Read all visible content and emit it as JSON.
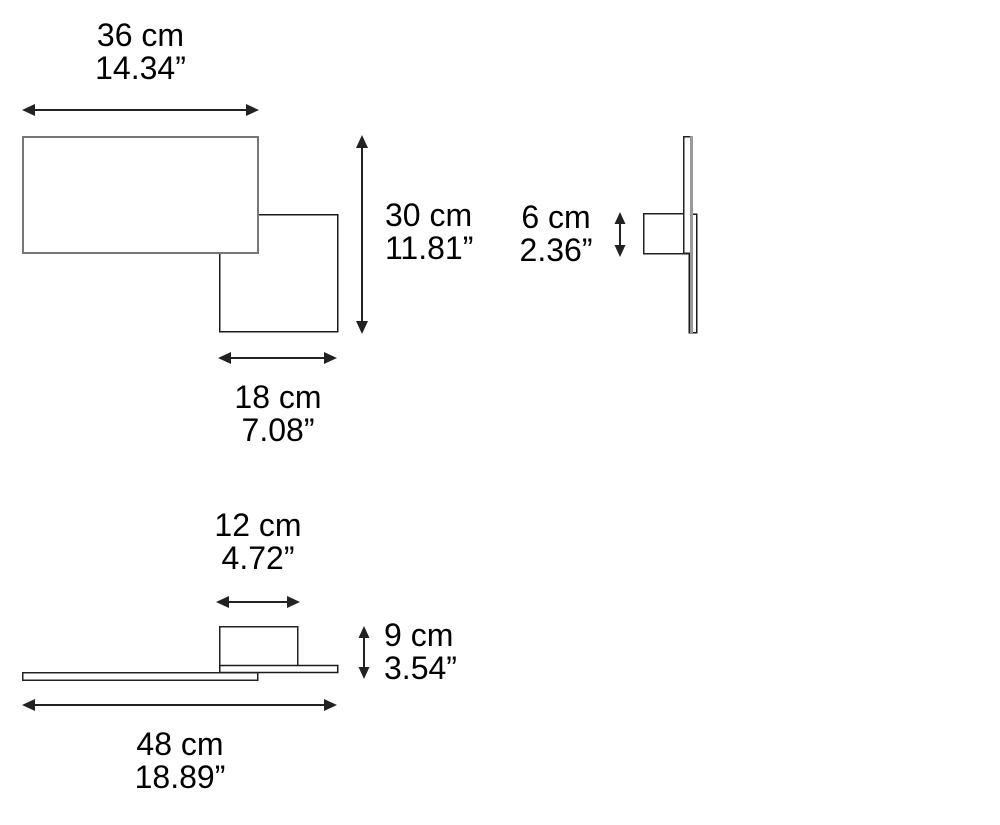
{
  "diagram": {
    "kind": "product-dimension-drawing",
    "views": [
      "front-view",
      "side-view",
      "top-view"
    ]
  },
  "dimensions": {
    "front_width": {
      "cm": "36 cm",
      "inch": "14.34”"
    },
    "front_height": {
      "cm": "30 cm",
      "inch": "11.81”"
    },
    "small_panel_width": {
      "cm": "18 cm",
      "inch": "7.08”"
    },
    "side_depth": {
      "cm": "6 cm",
      "inch": "2.36”"
    },
    "mount_width": {
      "cm": "12 cm",
      "inch": "4.72”"
    },
    "top_depth": {
      "cm": "9 cm",
      "inch": "3.54”"
    },
    "total_width": {
      "cm": "48 cm",
      "inch": "18.89”"
    }
  },
  "colors": {
    "background": "#ffffff",
    "line": "#222222",
    "large_panel_stroke": "#777777",
    "small_panel_stroke": "#1a1a1a",
    "wall_edge_gray": "#999999",
    "text": "#000000",
    "fill": "#ffffff"
  }
}
